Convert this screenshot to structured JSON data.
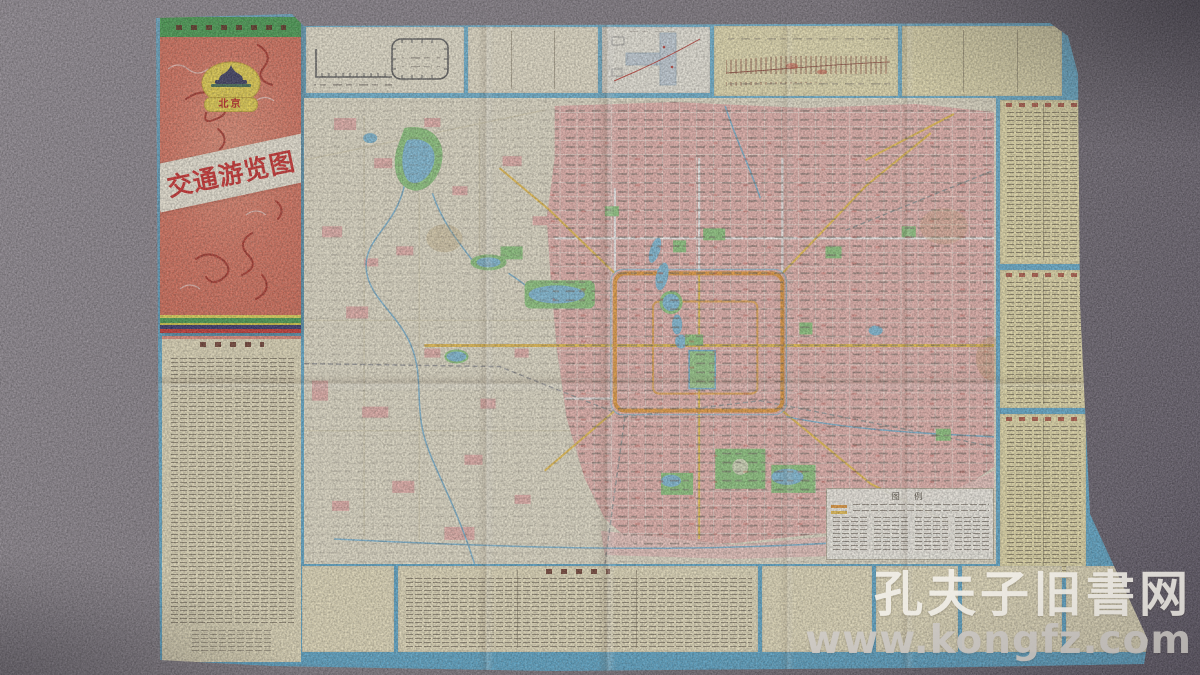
{
  "cover": {
    "badge_city": "北京",
    "title": "交通游览图"
  },
  "map": {
    "legend_title": "图 例"
  },
  "watermark": {
    "line1": "孔夫子旧書网",
    "line2": "www.kongfz.com"
  },
  "palette": {
    "carpet": "#7b747e",
    "cover_red": "#e0705a",
    "cover_band_green": "#3f9e4a",
    "badge_yellow": "#f0d848",
    "title_red": "#d32222",
    "map_pink": "#f2b8b2",
    "park_green": "#8ecf7e",
    "water_blue": "#84c4e2",
    "ring_orange": "#f09c36",
    "sheet_border_blue": "#5fb0d6",
    "panel_cream": "#efe8cc",
    "panel_yellow": "#f0e6ae",
    "watermark_white": "#f2efe8",
    "watermark_gray": "#cfcbc6"
  }
}
